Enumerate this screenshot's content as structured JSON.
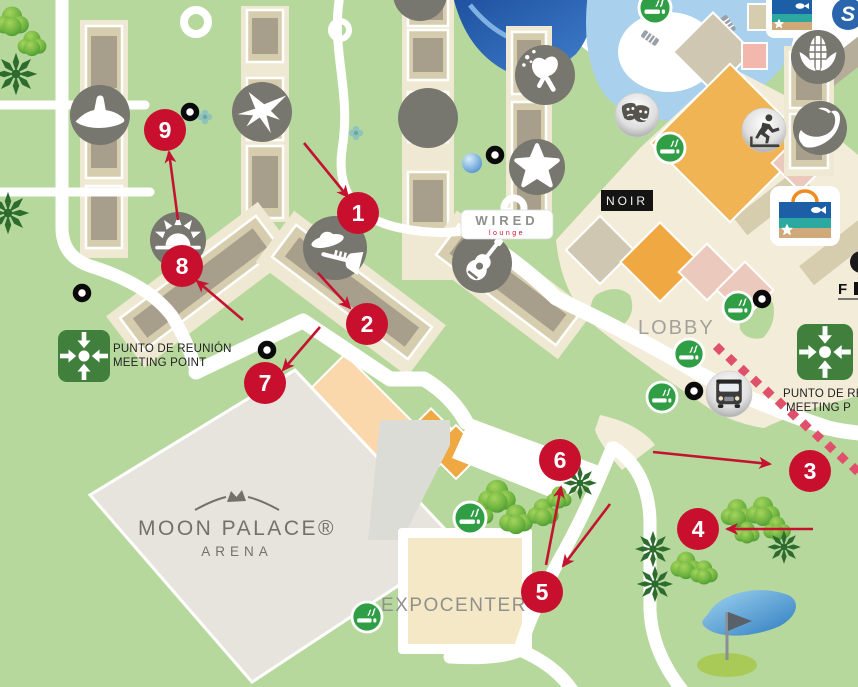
{
  "map": {
    "labels": {
      "arena_title": "MOON PALACE®",
      "arena_subtitle": "ARENA",
      "expocenter": "EXPOCENTER",
      "lobby": "LOBBY",
      "noir": "NOIR",
      "wired": "WIRED",
      "wired_sub": "lounge",
      "meeting_left_line1": "PUNTO DE REUNIÓN",
      "meeting_left_line2": "MEETING POINT",
      "meeting_right_line1": "PUNTO DE RE",
      "meeting_right_line2": "MEETING P",
      "flag_logo": "F"
    },
    "colors": {
      "ground": "#b7d89c",
      "road": "#ffffff",
      "marker": "#c8102e",
      "arrow": "#c41230",
      "route_dash": "#e0506a",
      "icon_circle": "#77766f",
      "smoking_green": "#2f9e44",
      "meeting_green": "#41803c",
      "cream": "#f3ecd8",
      "building_khaki": "#d6cdaf",
      "building_core": "#a79e8b",
      "arena_gray": "#e7e4dd",
      "expocenter_tan": "#f5e8c7",
      "orange": "#f0a843",
      "peach": "#fbd8ac",
      "pool_light": "#a9d0ec",
      "pool_dark": "#2a62b5"
    },
    "markers": [
      {
        "number": "1",
        "x": 358,
        "y": 213
      },
      {
        "number": "2",
        "x": 367,
        "y": 324
      },
      {
        "number": "3",
        "x": 810,
        "y": 471
      },
      {
        "number": "4",
        "x": 698,
        "y": 529
      },
      {
        "number": "5",
        "x": 542,
        "y": 592
      },
      {
        "number": "6",
        "x": 560,
        "y": 460
      },
      {
        "number": "7",
        "x": 265,
        "y": 383
      },
      {
        "number": "8",
        "x": 182,
        "y": 266
      },
      {
        "number": "9",
        "x": 165,
        "y": 130
      }
    ],
    "icons": [
      {
        "name": "sombrero-icon",
        "glyph": "sombrero",
        "x": 100,
        "y": 115,
        "r": 30,
        "style": "dark"
      },
      {
        "name": "bird-icon",
        "glyph": "bird",
        "x": 262,
        "y": 112,
        "r": 30,
        "style": "dark"
      },
      {
        "name": "crescent-moon-icon",
        "glyph": "crescent",
        "x": 428,
        "y": 118,
        "r": 30,
        "style": "dark"
      },
      {
        "name": "maracas-icon",
        "glyph": "maracas",
        "x": 545,
        "y": 75,
        "r": 30,
        "style": "dark"
      },
      {
        "name": "starfish-icon",
        "glyph": "star",
        "x": 537,
        "y": 167,
        "r": 28,
        "style": "dark"
      },
      {
        "name": "guitar-icon",
        "glyph": "guitar",
        "x": 482,
        "y": 263,
        "r": 30,
        "style": "dark"
      },
      {
        "name": "mariachi-icon",
        "glyph": "mariachi",
        "x": 335,
        "y": 248,
        "r": 32,
        "style": "dark"
      },
      {
        "name": "sun-icon",
        "glyph": "sun",
        "x": 178,
        "y": 240,
        "r": 28,
        "style": "dark"
      },
      {
        "name": "theater-masks-icon",
        "glyph": "masks",
        "x": 637,
        "y": 115,
        "r": 22,
        "style": "silver"
      },
      {
        "name": "gym-runner-icon",
        "glyph": "runner",
        "x": 764,
        "y": 130,
        "r": 22,
        "style": "silver"
      },
      {
        "name": "corn-icon",
        "glyph": "corn",
        "x": 818,
        "y": 57,
        "r": 27,
        "style": "dark"
      },
      {
        "name": "chili-icon",
        "glyph": "chili",
        "x": 820,
        "y": 128,
        "r": 27,
        "style": "dark"
      },
      {
        "name": "bus-icon",
        "glyph": "bus",
        "x": 729,
        "y": 394,
        "r": 23,
        "style": "silver"
      },
      {
        "name": "swirl-icon",
        "glyph": "swirl",
        "x": 848,
        "y": 14,
        "r": 16,
        "style": "blue"
      },
      {
        "name": "venue-icon-partial",
        "glyph": "",
        "x": 420,
        "y": -6,
        "r": 27,
        "style": "dark"
      }
    ],
    "smoking_areas": [
      {
        "x": 655,
        "y": 8,
        "r": 16
      },
      {
        "x": 670,
        "y": 148,
        "r": 15
      },
      {
        "x": 738,
        "y": 307,
        "r": 15
      },
      {
        "x": 689,
        "y": 354,
        "r": 15
      },
      {
        "x": 662,
        "y": 397,
        "r": 15
      },
      {
        "x": 470,
        "y": 518,
        "r": 16
      },
      {
        "x": 367,
        "y": 617,
        "r": 15
      }
    ],
    "location_dots": [
      {
        "x": 190,
        "y": 112
      },
      {
        "x": 82,
        "y": 293
      },
      {
        "x": 267,
        "y": 350
      },
      {
        "x": 495,
        "y": 155
      },
      {
        "x": 762,
        "y": 299
      },
      {
        "x": 694,
        "y": 391
      }
    ],
    "arrows": [
      {
        "x1": 304,
        "y1": 143,
        "x2": 348,
        "y2": 197
      },
      {
        "x1": 318,
        "y1": 273,
        "x2": 350,
        "y2": 308
      },
      {
        "x1": 320,
        "y1": 327,
        "x2": 283,
        "y2": 370
      },
      {
        "x1": 243,
        "y1": 320,
        "x2": 197,
        "y2": 281
      },
      {
        "x1": 178,
        "y1": 220,
        "x2": 169,
        "y2": 152
      },
      {
        "x1": 653,
        "y1": 452,
        "x2": 770,
        "y2": 464
      },
      {
        "x1": 813,
        "y1": 529,
        "x2": 727,
        "y2": 529
      },
      {
        "x1": 546,
        "y1": 565,
        "x2": 561,
        "y2": 487
      },
      {
        "x1": 610,
        "y1": 504,
        "x2": 563,
        "y2": 566
      }
    ],
    "route": {
      "from": {
        "x": 719,
        "y": 349
      },
      "to": {
        "x": 855,
        "y": 469
      },
      "dashes": 12
    },
    "meeting_points": [
      {
        "side": "left",
        "x": 84,
        "y": 356,
        "size": 52
      },
      {
        "side": "right",
        "x": 825,
        "y": 352,
        "size": 56
      }
    ]
  }
}
